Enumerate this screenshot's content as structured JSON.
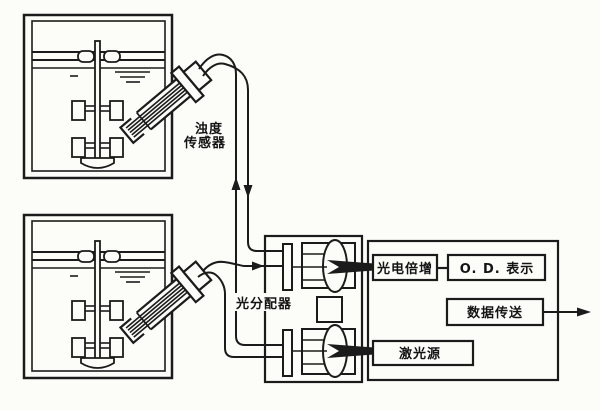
{
  "diagram": {
    "type": "schematic",
    "description_visible_text_only": true,
    "labels": {
      "turbidity_sensor_line1": "浊度",
      "turbidity_sensor_line2": "传感器",
      "light_distributor": "光分配器",
      "photomultiplier": "光电倍增",
      "od_display": "O. D. 表示",
      "data_transfer": "数据传送",
      "laser_source": "激光源"
    },
    "colors": {
      "ink": "#1b1b1b",
      "paper": "#fcfcf9"
    },
    "arrows": {
      "upper_fiber_left": "up",
      "upper_fiber_right": "down",
      "lower_fiber_to_distributor": "right",
      "data_output": "right"
    }
  }
}
